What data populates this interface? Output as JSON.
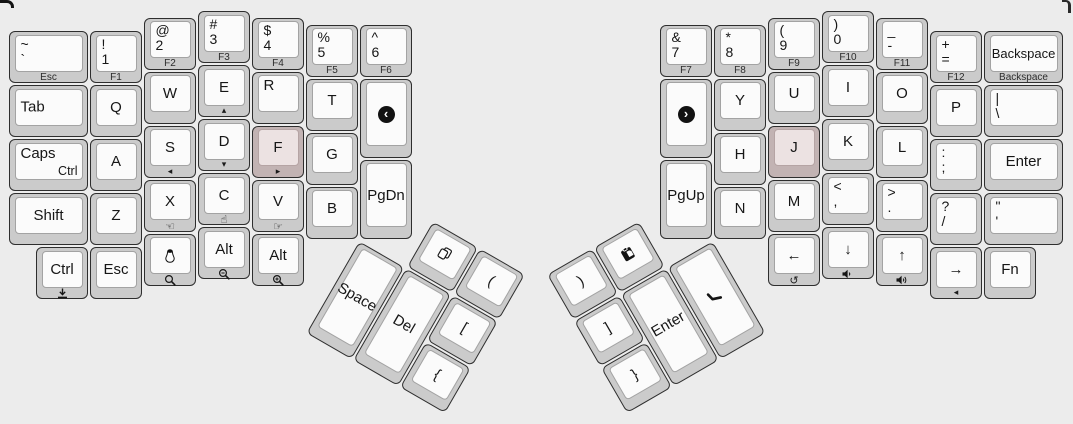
{
  "canvas": {
    "width": 1073,
    "height": 424,
    "background": "#ececec",
    "unit": 54
  },
  "colors": {
    "key_base": "#cbcbcb",
    "key_top": "#fbfbfb",
    "key_outline": "#2e2e2e",
    "key_top_border": "#a3a3a3",
    "homing_base": "#c2b3b3",
    "homing_top": "#ece2e2",
    "legend": "#161616",
    "front_legend": "#2c2c2c",
    "media_circle": "#121212"
  },
  "clusters": {
    "left": {
      "ox": 8,
      "oy": 10
    },
    "right": {
      "ox": 659,
      "oy": 10
    },
    "lthumb": {
      "ox": 359,
      "oy": 185.5,
      "w": 162,
      "h": 162,
      "rotate": 30,
      "origin": "0px 54px"
    },
    "rthumb": {
      "ox": 551,
      "oy": 185.5,
      "w": 162,
      "h": 162,
      "rotate": -30,
      "origin": "162px 54px"
    }
  },
  "keys": [
    {
      "name": "grave",
      "cluster": "left",
      "x": 0,
      "y": 0.375,
      "w": 1.5,
      "legend": {
        "stack": [
          "~",
          "`"
        ],
        "front": "Esc"
      }
    },
    {
      "name": "1",
      "cluster": "left",
      "x": 1.5,
      "y": 0.375,
      "legend": {
        "stack": [
          "!",
          "1"
        ],
        "front": "F1"
      }
    },
    {
      "name": "2",
      "cluster": "left",
      "x": 2.5,
      "y": 0.125,
      "legend": {
        "stack": [
          "@",
          "2"
        ],
        "front": "F2"
      }
    },
    {
      "name": "3",
      "cluster": "left",
      "x": 3.5,
      "y": 0,
      "legend": {
        "stack": [
          "#",
          "3"
        ],
        "front": "F3"
      }
    },
    {
      "name": "4",
      "cluster": "left",
      "x": 4.5,
      "y": 0.125,
      "legend": {
        "stack": [
          "$",
          "4"
        ],
        "front": "F4"
      }
    },
    {
      "name": "5",
      "cluster": "left",
      "x": 5.5,
      "y": 0.25,
      "legend": {
        "stack": [
          "%",
          "5"
        ],
        "front": "F5"
      }
    },
    {
      "name": "6",
      "cluster": "left",
      "x": 6.5,
      "y": 0.25,
      "legend": {
        "stack": [
          "^",
          "6"
        ],
        "front": "F6"
      }
    },
    {
      "name": "tab",
      "cluster": "left",
      "x": 0,
      "y": 1.375,
      "w": 1.5,
      "legend": {
        "left": "Tab"
      }
    },
    {
      "name": "q",
      "cluster": "left",
      "x": 1.5,
      "y": 1.375,
      "legend": {
        "center": "Q"
      }
    },
    {
      "name": "w",
      "cluster": "left",
      "x": 2.5,
      "y": 1.125,
      "legend": {
        "center": "W"
      }
    },
    {
      "name": "e",
      "cluster": "left",
      "x": 3.5,
      "y": 1,
      "legend": {
        "center": "E"
      },
      "front_icon": "triangle-up"
    },
    {
      "name": "r",
      "cluster": "left",
      "x": 4.5,
      "y": 1.125,
      "legend": {
        "topleft": "R"
      }
    },
    {
      "name": "t",
      "cluster": "left",
      "x": 5.5,
      "y": 1.25,
      "legend": {
        "center": "T"
      }
    },
    {
      "name": "media-previous",
      "cluster": "left",
      "x": 6.5,
      "y": 1.25,
      "h": 1.5,
      "center_icon": "media-prev"
    },
    {
      "name": "caps",
      "cluster": "left",
      "x": 0,
      "y": 2.375,
      "w": 1.5,
      "legend": {
        "topleft": "Caps",
        "bottomright": "Ctrl"
      }
    },
    {
      "name": "a",
      "cluster": "left",
      "x": 1.5,
      "y": 2.375,
      "legend": {
        "center": "A"
      }
    },
    {
      "name": "s",
      "cluster": "left",
      "x": 2.5,
      "y": 2.125,
      "legend": {
        "center": "S"
      },
      "front_icon": "triangle-left"
    },
    {
      "name": "d",
      "cluster": "left",
      "x": 3.5,
      "y": 2,
      "legend": {
        "center": "D"
      },
      "front_icon": "triangle-down"
    },
    {
      "name": "f",
      "cluster": "left",
      "x": 4.5,
      "y": 2.125,
      "legend": {
        "center": "F"
      },
      "front_icon": "triangle-right",
      "homing": true
    },
    {
      "name": "g",
      "cluster": "left",
      "x": 5.5,
      "y": 2.25,
      "legend": {
        "center": "G"
      }
    },
    {
      "name": "pgdn",
      "cluster": "left",
      "x": 6.5,
      "y": 2.75,
      "h": 1.5,
      "legend": {
        "center": "PgDn"
      }
    },
    {
      "name": "shift",
      "cluster": "left",
      "x": 0,
      "y": 3.375,
      "w": 1.5,
      "legend": {
        "center": "Shift"
      }
    },
    {
      "name": "z",
      "cluster": "left",
      "x": 1.5,
      "y": 3.375,
      "legend": {
        "center": "Z"
      }
    },
    {
      "name": "x",
      "cluster": "left",
      "x": 2.5,
      "y": 3.125,
      "legend": {
        "center": "X"
      },
      "front_icon": "hand-left"
    },
    {
      "name": "c",
      "cluster": "left",
      "x": 3.5,
      "y": 3,
      "legend": {
        "center": "C"
      },
      "front_icon": "hand-up"
    },
    {
      "name": "v",
      "cluster": "left",
      "x": 4.5,
      "y": 3.125,
      "legend": {
        "center": "V"
      },
      "front_icon": "hand-right"
    },
    {
      "name": "b",
      "cluster": "left",
      "x": 5.5,
      "y": 3.25,
      "legend": {
        "center": "B"
      }
    },
    {
      "name": "ctrl",
      "cluster": "left",
      "x": 0.5,
      "y": 4.375,
      "legend": {
        "center": "Ctrl"
      },
      "front_icon": "download"
    },
    {
      "name": "esc",
      "cluster": "left",
      "x": 1.5,
      "y": 4.375,
      "legend": {
        "center": "Esc"
      }
    },
    {
      "name": "linux",
      "cluster": "left",
      "x": 2.5,
      "y": 4.125,
      "center_icon": "penguin",
      "front_icon": "magnifier"
    },
    {
      "name": "alt-1",
      "cluster": "left",
      "x": 3.5,
      "y": 4,
      "legend": {
        "center": "Alt"
      },
      "front_icon": "magnifier-minus"
    },
    {
      "name": "alt-2",
      "cluster": "left",
      "x": 4.5,
      "y": 4.125,
      "legend": {
        "center": "Alt"
      },
      "front_icon": "magnifier-plus"
    },
    {
      "name": "7",
      "cluster": "right",
      "x": 0,
      "y": 0.25,
      "legend": {
        "stack": [
          "&",
          "7"
        ],
        "front": "F7"
      }
    },
    {
      "name": "8",
      "cluster": "right",
      "x": 1,
      "y": 0.25,
      "legend": {
        "stack": [
          "*",
          "8"
        ],
        "front": "F8"
      }
    },
    {
      "name": "9",
      "cluster": "right",
      "x": 2,
      "y": 0.125,
      "legend": {
        "stack": [
          "(",
          "9"
        ],
        "front": "F9"
      }
    },
    {
      "name": "0",
      "cluster": "right",
      "x": 3,
      "y": 0,
      "legend": {
        "stack": [
          ")",
          "0"
        ],
        "front": "F10"
      }
    },
    {
      "name": "minus",
      "cluster": "right",
      "x": 4,
      "y": 0.125,
      "legend": {
        "stack": [
          "_",
          "-"
        ],
        "front": "F11"
      }
    },
    {
      "name": "equals",
      "cluster": "right",
      "x": 5,
      "y": 0.375,
      "legend": {
        "stack": [
          "+",
          "="
        ],
        "front": "F12"
      }
    },
    {
      "name": "backspace",
      "cluster": "right",
      "x": 6,
      "y": 0.375,
      "w": 1.5,
      "legend": {
        "center": "Backspace",
        "front": "Backspace"
      }
    },
    {
      "name": "media-next",
      "cluster": "right",
      "x": 0,
      "y": 1.25,
      "h": 1.5,
      "center_icon": "media-next"
    },
    {
      "name": "y",
      "cluster": "right",
      "x": 1,
      "y": 1.25,
      "legend": {
        "center": "Y"
      }
    },
    {
      "name": "u",
      "cluster": "right",
      "x": 2,
      "y": 1.125,
      "legend": {
        "center": "U"
      }
    },
    {
      "name": "i",
      "cluster": "right",
      "x": 3,
      "y": 1,
      "legend": {
        "center": "I"
      }
    },
    {
      "name": "o",
      "cluster": "right",
      "x": 4,
      "y": 1.125,
      "legend": {
        "center": "O"
      }
    },
    {
      "name": "p",
      "cluster": "right",
      "x": 5,
      "y": 1.375,
      "legend": {
        "center": "P"
      }
    },
    {
      "name": "backslash",
      "cluster": "right",
      "x": 6,
      "y": 1.375,
      "w": 1.5,
      "legend": {
        "stack": [
          "|",
          "\\"
        ]
      }
    },
    {
      "name": "pgup",
      "cluster": "right",
      "x": 0,
      "y": 2.75,
      "h": 1.5,
      "legend": {
        "center": "PgUp"
      }
    },
    {
      "name": "h",
      "cluster": "right",
      "x": 1,
      "y": 2.25,
      "legend": {
        "center": "H"
      }
    },
    {
      "name": "j",
      "cluster": "right",
      "x": 2,
      "y": 2.125,
      "legend": {
        "center": "J"
      },
      "homing": true
    },
    {
      "name": "k",
      "cluster": "right",
      "x": 3,
      "y": 2,
      "legend": {
        "center": "K"
      }
    },
    {
      "name": "l",
      "cluster": "right",
      "x": 4,
      "y": 2.125,
      "legend": {
        "center": "L"
      }
    },
    {
      "name": "semicolon",
      "cluster": "right",
      "x": 5,
      "y": 2.375,
      "legend": {
        "stack": [
          ":",
          ";"
        ]
      }
    },
    {
      "name": "enter",
      "cluster": "right",
      "x": 6,
      "y": 2.375,
      "w": 1.5,
      "legend": {
        "center": "Enter"
      }
    },
    {
      "name": "n",
      "cluster": "right",
      "x": 1,
      "y": 3.25,
      "legend": {
        "center": "N"
      }
    },
    {
      "name": "m",
      "cluster": "right",
      "x": 2,
      "y": 3.125,
      "legend": {
        "center": "M"
      }
    },
    {
      "name": "comma",
      "cluster": "right",
      "x": 3,
      "y": 3,
      "legend": {
        "stack": [
          "<",
          ","
        ]
      }
    },
    {
      "name": "period",
      "cluster": "right",
      "x": 4,
      "y": 3.125,
      "legend": {
        "stack": [
          ">",
          "."
        ]
      }
    },
    {
      "name": "slash",
      "cluster": "right",
      "x": 5,
      "y": 3.375,
      "legend": {
        "stack": [
          "?",
          "/"
        ]
      }
    },
    {
      "name": "quote",
      "cluster": "right",
      "x": 6,
      "y": 3.375,
      "w": 1.5,
      "legend": {
        "stack": [
          "\"",
          "'"
        ]
      }
    },
    {
      "name": "arrow-left",
      "cluster": "right",
      "x": 2,
      "y": 4.125,
      "legend": {
        "center": "←"
      },
      "front_icon": "undo"
    },
    {
      "name": "arrow-down",
      "cluster": "right",
      "x": 3,
      "y": 4,
      "legend": {
        "center": "↓"
      },
      "front_icon": "volume-down"
    },
    {
      "name": "arrow-up",
      "cluster": "right",
      "x": 4,
      "y": 4.125,
      "legend": {
        "center": "↑"
      },
      "front_icon": "volume-up"
    },
    {
      "name": "arrow-right",
      "cluster": "right",
      "x": 5,
      "y": 4.375,
      "legend": {
        "center": "→"
      },
      "front_icon": "triangle-left"
    },
    {
      "name": "fn",
      "cluster": "right",
      "x": 6,
      "y": 4.375,
      "legend": {
        "center": "Fn"
      }
    },
    {
      "name": "copy",
      "cluster": "lthumb",
      "x": 1,
      "y": 0,
      "center_icon": "copy"
    },
    {
      "name": "paren-open",
      "cluster": "lthumb",
      "x": 2,
      "y": 0,
      "legend": {
        "center": "("
      }
    },
    {
      "name": "space",
      "cluster": "lthumb",
      "x": 0,
      "y": 1,
      "h": 2,
      "legend": {
        "center": "Space"
      }
    },
    {
      "name": "del",
      "cluster": "lthumb",
      "x": 1,
      "y": 1,
      "h": 2,
      "legend": {
        "center": "Del"
      }
    },
    {
      "name": "bracket-open",
      "cluster": "lthumb",
      "x": 2,
      "y": 1,
      "legend": {
        "center": "["
      }
    },
    {
      "name": "brace-open",
      "cluster": "lthumb",
      "x": 2,
      "y": 2,
      "legend": {
        "center": "{"
      }
    },
    {
      "name": "paren-close",
      "cluster": "rthumb",
      "x": 0,
      "y": 0,
      "legend": {
        "center": ")"
      }
    },
    {
      "name": "paste",
      "cluster": "rthumb",
      "x": 1,
      "y": 0,
      "center_icon": "paste"
    },
    {
      "name": "bracket-close",
      "cluster": "rthumb",
      "x": 0,
      "y": 1,
      "legend": {
        "center": "]"
      }
    },
    {
      "name": "enter-thumb",
      "cluster": "rthumb",
      "x": 1,
      "y": 1,
      "h": 2,
      "legend": {
        "center": "Enter"
      }
    },
    {
      "name": "phone",
      "cluster": "rthumb",
      "x": 2,
      "y": 1,
      "h": 2,
      "center_icon": "phone"
    },
    {
      "name": "brace-close",
      "cluster": "rthumb",
      "x": 0,
      "y": 2,
      "legend": {
        "center": "}"
      }
    }
  ]
}
